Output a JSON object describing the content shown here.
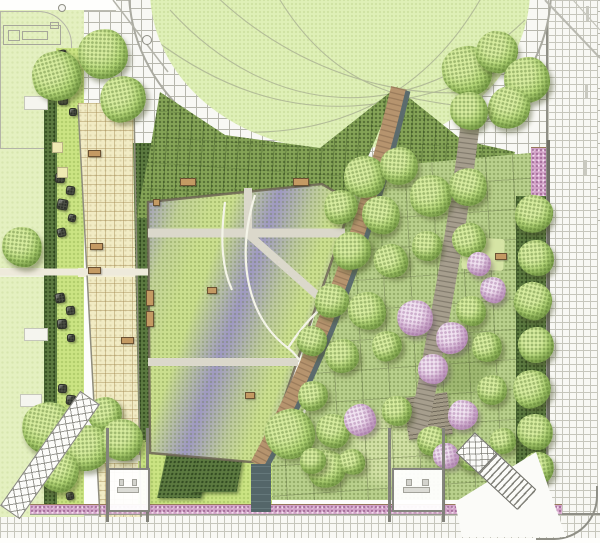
{
  "scene": {
    "type": "landscape-architecture-site-plan",
    "width": 600,
    "height": 543,
    "features": [
      "oval-lawn",
      "curved-grid-path-band",
      "purple-meadow-garden",
      "timber-boardwalk",
      "water-channel",
      "tree-grove-with-blossoms",
      "stone-promenade",
      "boulder-garden",
      "hedge-bands",
      "flowering-border-strip",
      "perimeter-sidewalks",
      "bus-shelters",
      "stairs-southwest",
      "stairs-southeast",
      "adjacent-parcel-building"
    ]
  },
  "palette": {
    "grid-bg": "#f8f8f4",
    "grid-line": "#b7b7ad",
    "grid-line-soft": "#c6c6bc",
    "lawn-pale": "#e4f0c0",
    "lawn-oval": "#dff0b7",
    "lawn-bright": "#cbe483",
    "hedge-dark": "#5c7a40",
    "hedge-mid": "#85a457",
    "meadow-green": "#cade8e",
    "meadow-purple": "#988cce",
    "grove-base": "#b9d08c",
    "promenade": "#f1ebc4",
    "tree-green": "#b5d878",
    "blossom": "#dabcd9",
    "pink-strip": "#d2a3c8",
    "boardwalk": "#b6946e",
    "channel": "#5b6b6d",
    "water": "#546669",
    "bench": "#c49a63",
    "boulder": "#4d5146"
  },
  "trees": [
    {
      "x": 57,
      "y": 76,
      "r": 25,
      "t": "g"
    },
    {
      "x": 103,
      "y": 54,
      "r": 25,
      "t": "g"
    },
    {
      "x": 123,
      "y": 99,
      "r": 23,
      "t": "g"
    },
    {
      "x": 22,
      "y": 247,
      "r": 20,
      "t": "g"
    },
    {
      "x": 105,
      "y": 414,
      "r": 17,
      "t": "g"
    },
    {
      "x": 48,
      "y": 428,
      "r": 26,
      "t": "g"
    },
    {
      "x": 88,
      "y": 448,
      "r": 23,
      "t": "g"
    },
    {
      "x": 58,
      "y": 471,
      "r": 21,
      "t": "g"
    },
    {
      "x": 122,
      "y": 440,
      "r": 21,
      "t": "g"
    },
    {
      "x": 290,
      "y": 434,
      "r": 25,
      "t": "g"
    },
    {
      "x": 327,
      "y": 469,
      "r": 19,
      "t": "g"
    },
    {
      "x": 467,
      "y": 71,
      "r": 25,
      "t": "g"
    },
    {
      "x": 497,
      "y": 52,
      "r": 21,
      "t": "g"
    },
    {
      "x": 527,
      "y": 80,
      "r": 23,
      "t": "g"
    },
    {
      "x": 509,
      "y": 108,
      "r": 21,
      "t": "g"
    },
    {
      "x": 469,
      "y": 111,
      "r": 19,
      "t": "g"
    },
    {
      "x": 365,
      "y": 177,
      "r": 21,
      "t": "g"
    },
    {
      "x": 399,
      "y": 166,
      "r": 19,
      "t": "g"
    },
    {
      "x": 341,
      "y": 207,
      "r": 17,
      "t": "g"
    },
    {
      "x": 381,
      "y": 215,
      "r": 19,
      "t": "g"
    },
    {
      "x": 431,
      "y": 196,
      "r": 21,
      "t": "g"
    },
    {
      "x": 468,
      "y": 187,
      "r": 19,
      "t": "g"
    },
    {
      "x": 352,
      "y": 251,
      "r": 19,
      "t": "g"
    },
    {
      "x": 391,
      "y": 261,
      "r": 17,
      "t": "g"
    },
    {
      "x": 427,
      "y": 246,
      "r": 15,
      "t": "g"
    },
    {
      "x": 469,
      "y": 240,
      "r": 17,
      "t": "g"
    },
    {
      "x": 332,
      "y": 301,
      "r": 17,
      "t": "g"
    },
    {
      "x": 367,
      "y": 311,
      "r": 19,
      "t": "g"
    },
    {
      "x": 312,
      "y": 341,
      "r": 15,
      "t": "g"
    },
    {
      "x": 342,
      "y": 356,
      "r": 17,
      "t": "g"
    },
    {
      "x": 387,
      "y": 346,
      "r": 15,
      "t": "g"
    },
    {
      "x": 471,
      "y": 311,
      "r": 15,
      "t": "g"
    },
    {
      "x": 487,
      "y": 347,
      "r": 15,
      "t": "g"
    },
    {
      "x": 492,
      "y": 390,
      "r": 15,
      "t": "g"
    },
    {
      "x": 313,
      "y": 396,
      "r": 15,
      "t": "g"
    },
    {
      "x": 333,
      "y": 431,
      "r": 17,
      "t": "g"
    },
    {
      "x": 397,
      "y": 411,
      "r": 15,
      "t": "g"
    },
    {
      "x": 432,
      "y": 441,
      "r": 15,
      "t": "g"
    },
    {
      "x": 313,
      "y": 461,
      "r": 13,
      "t": "g"
    },
    {
      "x": 352,
      "y": 462,
      "r": 13,
      "t": "g"
    },
    {
      "x": 472,
      "y": 456,
      "r": 15,
      "t": "g"
    },
    {
      "x": 503,
      "y": 441,
      "r": 13,
      "t": "g"
    },
    {
      "x": 534,
      "y": 214,
      "r": 19,
      "t": "g"
    },
    {
      "x": 536,
      "y": 258,
      "r": 18,
      "t": "g"
    },
    {
      "x": 533,
      "y": 301,
      "r": 19,
      "t": "g"
    },
    {
      "x": 536,
      "y": 345,
      "r": 18,
      "t": "g"
    },
    {
      "x": 532,
      "y": 389,
      "r": 19,
      "t": "g"
    },
    {
      "x": 535,
      "y": 432,
      "r": 18,
      "t": "g"
    },
    {
      "x": 538,
      "y": 468,
      "r": 16,
      "t": "g"
    },
    {
      "x": 415,
      "y": 318,
      "r": 18,
      "t": "b"
    },
    {
      "x": 452,
      "y": 338,
      "r": 16,
      "t": "b"
    },
    {
      "x": 493,
      "y": 290,
      "r": 13,
      "t": "b"
    },
    {
      "x": 433,
      "y": 369,
      "r": 15,
      "t": "b"
    },
    {
      "x": 360,
      "y": 420,
      "r": 16,
      "t": "b"
    },
    {
      "x": 463,
      "y": 415,
      "r": 15,
      "t": "b"
    },
    {
      "x": 446,
      "y": 456,
      "r": 13,
      "t": "b"
    },
    {
      "x": 479,
      "y": 264,
      "r": 12,
      "t": "b"
    }
  ],
  "boulders": [
    [
      62,
      55,
      10
    ],
    [
      72,
      64,
      9
    ],
    [
      60,
      76,
      11
    ],
    [
      70,
      88,
      9
    ],
    [
      63,
      100,
      10
    ],
    [
      73,
      112,
      8
    ],
    [
      60,
      178,
      10
    ],
    [
      70,
      190,
      9
    ],
    [
      62,
      204,
      11
    ],
    [
      72,
      218,
      8
    ],
    [
      61,
      232,
      9
    ],
    [
      60,
      298,
      10
    ],
    [
      70,
      310,
      9
    ],
    [
      62,
      324,
      10
    ],
    [
      71,
      338,
      8
    ],
    [
      62,
      388,
      9
    ],
    [
      71,
      400,
      10
    ],
    [
      60,
      458,
      10
    ],
    [
      70,
      470,
      9
    ],
    [
      62,
      484,
      10
    ],
    [
      70,
      496,
      8
    ]
  ],
  "benches": [
    [
      88,
      150,
      13,
      7
    ],
    [
      90,
      243,
      13,
      7
    ],
    [
      88,
      267,
      13,
      7
    ],
    [
      121,
      337,
      13,
      7
    ],
    [
      92,
      408,
      13,
      7
    ],
    [
      119,
      453,
      13,
      7
    ],
    [
      180,
      178,
      16,
      8
    ],
    [
      293,
      178,
      16,
      8
    ],
    [
      146,
      290,
      8,
      16
    ],
    [
      146,
      311,
      8,
      16
    ],
    [
      207,
      287,
      10,
      7
    ],
    [
      245,
      392,
      10,
      7
    ],
    [
      495,
      253,
      12,
      7
    ],
    [
      153,
      199,
      7,
      7
    ]
  ],
  "pads": [
    [
      52,
      142,
      11
    ],
    [
      57,
      167,
      11
    ]
  ],
  "slabs": [
    [
      24,
      96,
      24,
      14
    ],
    [
      24,
      328,
      24,
      13
    ],
    [
      20,
      394,
      22,
      13
    ]
  ],
  "posts": [
    [
      106,
      428,
      94
    ],
    [
      146,
      428,
      94
    ],
    [
      388,
      428,
      94
    ],
    [
      442,
      428,
      94
    ]
  ],
  "shelters": [
    [
      108,
      468,
      42,
      44
    ],
    [
      392,
      468,
      52,
      44
    ]
  ],
  "hedge_blocks": [
    [
      150,
      396,
      38,
      46,
      -12
    ],
    [
      162,
      452,
      44,
      46,
      -12
    ],
    [
      198,
      408,
      46,
      84,
      -10
    ]
  ],
  "markers": [
    [
      62,
      8,
      4
    ],
    [
      147,
      40,
      5
    ]
  ],
  "lane_dashes": [
    [
      586,
      6,
      3,
      15
    ],
    [
      585,
      84,
      3,
      15
    ],
    [
      584,
      160,
      3,
      15
    ]
  ]
}
